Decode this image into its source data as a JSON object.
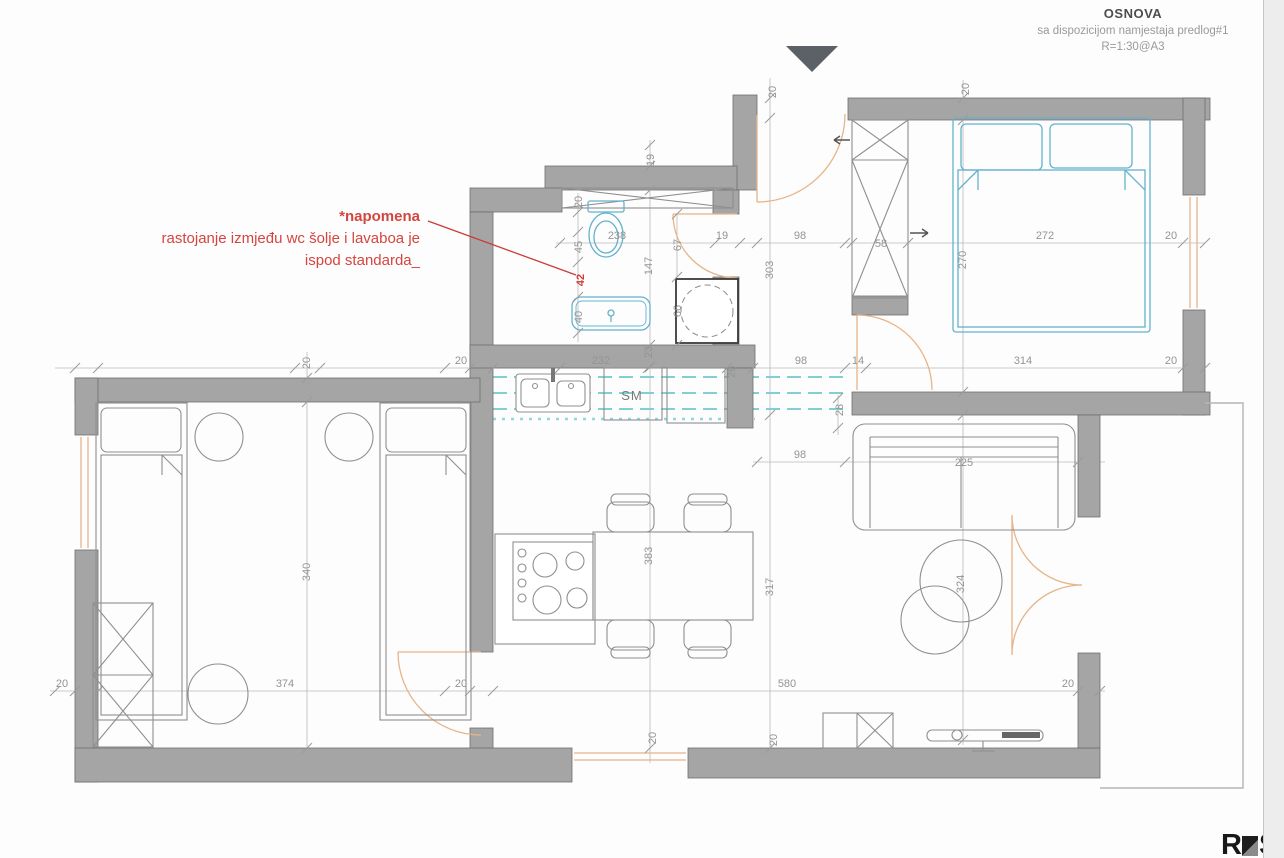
{
  "title_block": {
    "title": "OSNOVA",
    "subtitle": "sa dispozicijom namjestaja predlog#1",
    "scale": "R=1:30@A3"
  },
  "note": {
    "heading": "*napomena",
    "body_line1": "rastojanje izmjeđu wc šolje i lavaboa je",
    "body_line2": "ispod standarda_"
  },
  "labels": {
    "washing_machine": "SM"
  },
  "logo": {
    "prefix": "R",
    "suffix": "Sk"
  },
  "colors": {
    "wall_gray": "#a5a5a5",
    "fixture_blue": "#64b2cd",
    "door_window_orange": "#e7b489",
    "counter_teal": "#7fcfd4",
    "annotation_red": "#d5453f",
    "dimension_gray": "#949494"
  },
  "dimensions": {
    "bath_wall_top": "20",
    "wc_side_45": "45",
    "wc_lavabo_gap": "42",
    "tub_width": "40",
    "bath_top_offset": "19",
    "bath_inner_height": "147",
    "bath_bottom_wall": "23",
    "dining_height": "383",
    "bottom_window_left": "20",
    "bath_door_width": "67",
    "shower_width": "66",
    "bath_width": "238",
    "bath_right_wall": "19",
    "hall_width_top": "98",
    "wardrobe_depth": "58",
    "bedroom_width": "272",
    "right_wall_top": "20",
    "entry_jamb": "20",
    "hall_height": "303",
    "living_height": "317",
    "bottom_window_right": "20",
    "wardrobe_top_wall": "20",
    "bedroom_height": "270",
    "lounge_tables": "324",
    "bedroom2_top_wall": "20",
    "kitchen_corner": "20",
    "counter_width": "232",
    "counter_stub": "26",
    "hall_width_mid": "98",
    "bedroom_door_jamb": "14",
    "bedroom_width_bottom": "314",
    "right_wall_mid": "20",
    "sofa_wall": "28",
    "sofa_gap": "98",
    "sofa_width": "225",
    "bedroom2_height": "340",
    "left_wall_bottom": "20",
    "bedroom2_width": "374",
    "bedroom2_door": "20",
    "living_width": "580",
    "right_wall_bottom": "20"
  }
}
